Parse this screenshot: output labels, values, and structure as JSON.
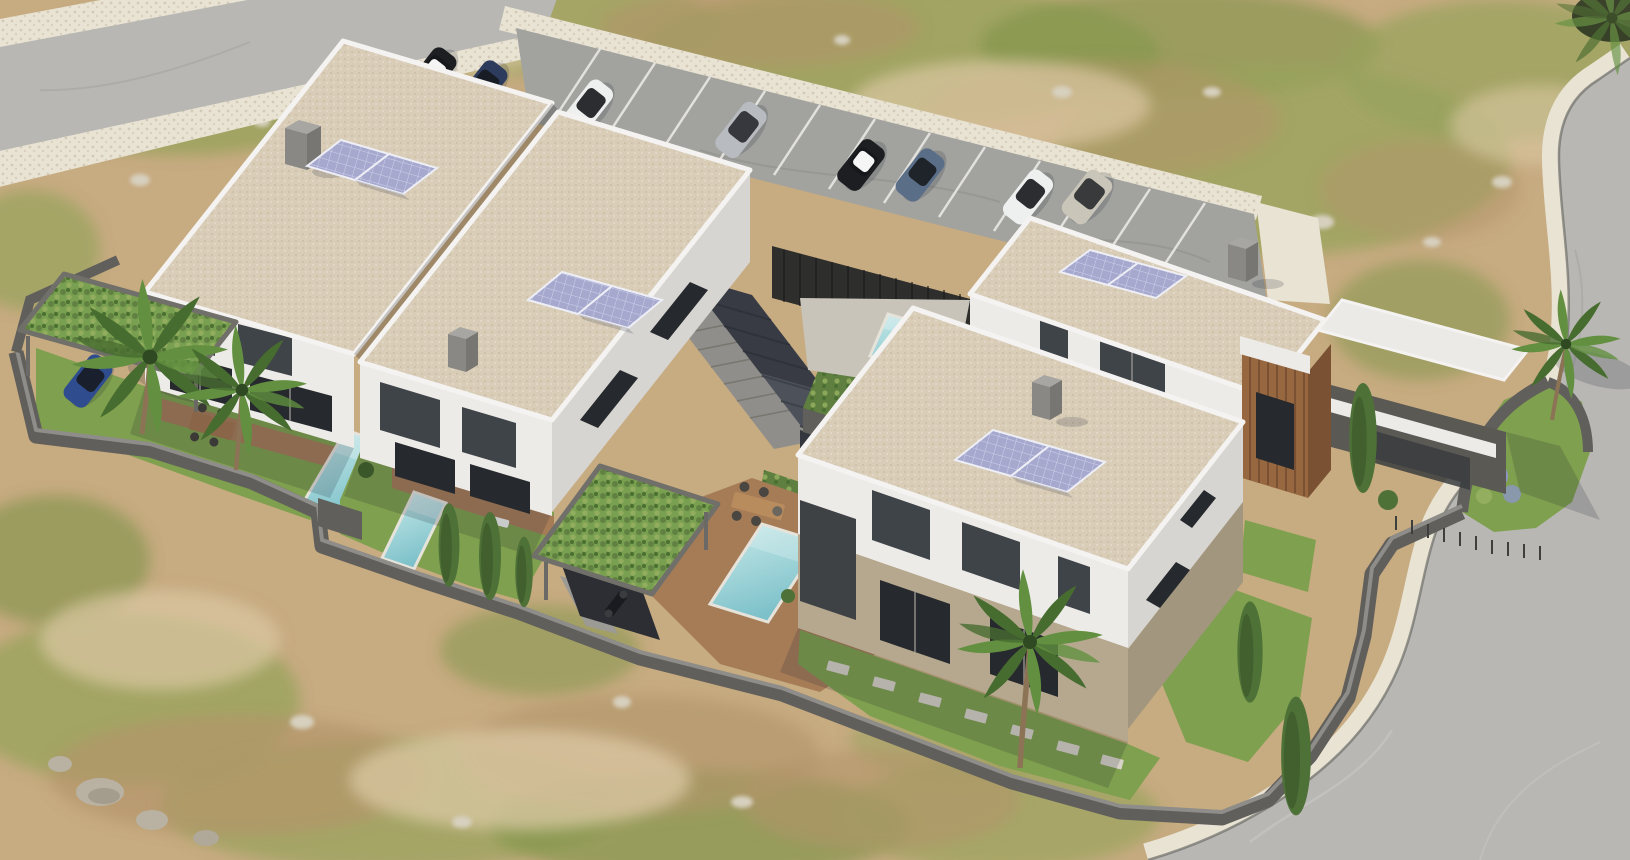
{
  "scene": {
    "title": "Aerial 3D architectural rendering of a modern villa development on a semi-arid plot",
    "type": "architectural-visualization",
    "view": "aerial-oblique",
    "inventory": {
      "building_volumes": 4,
      "duplex_units": 2,
      "detached_villas": 2,
      "rooftop_solar_arrays": 4,
      "solar_panels_per_array": 2,
      "swimming_pools": 4,
      "parked_cars": 8,
      "carport_cars": 1,
      "motorbikes": 1,
      "palm_trees": 5,
      "cypress_trees": 6,
      "green_roof_pergolas": 2,
      "outdoor_dining_sets": 2,
      "sun_loungers": 2,
      "roads": 2,
      "parking_bays": 12
    }
  },
  "colors": {
    "terrain_sand": "#c7ab81",
    "terrain_sand_light": "#dbc8a4",
    "terrain_dirt": "#b3946a",
    "grass_patch": "#97a35b",
    "grass_patch_dark": "#7e9348",
    "stone": "#d7d0bf",
    "road_asphalt": "#b8b7b3",
    "parking_asphalt": "#a2a39f",
    "cobble": "#e9e3d4",
    "cobble_dot": "#d3cbb8",
    "roof_gravel": "#d9cdb8",
    "roof_speckle": "#c1b398",
    "fascia_white": "#f4f3f1",
    "wall_white": "#edebe8",
    "wall_white_shade": "#d7d5d1",
    "wall_beige": "#b5a88f",
    "wall_beige_shade": "#a2967e",
    "window_glass": "#3f4449",
    "window_glass_dark": "#26292d",
    "perimeter_wall_top": "#8e8d89",
    "perimeter_wall_face": "#615f5b",
    "fence_dark": "#2e2e2c",
    "ramp_paving": "#4d5159",
    "stair_concrete": "#8f8e8a",
    "pool_water_light": "#c7e8e8",
    "pool_water": "#9fd4d8",
    "pool_water_deep": "#7cc0c9",
    "pool_rim": "#e6e3db",
    "deck_wood": "#a67c57",
    "deck_wood_dark": "#8a6547",
    "lawn": "#7fa04e",
    "lawn_light": "#93ae5f",
    "pergola_leaves": "#79a050",
    "pergola_frame": "#716f6a",
    "hedge_green": "#5f7f40",
    "palm_frond": "#629040",
    "palm_frond_dark": "#476c2f",
    "palm_trunk": "#8d7355",
    "cypress": "#4e7138",
    "cypress_dark": "#3a5729",
    "wood_slats": "#97683f",
    "wood_slats_dark": "#7a5233",
    "solar_panel": "#a6a8ce",
    "solar_grid": "#ced1e9",
    "solar_frame": "#edeef6",
    "stall_line": "#e9e8e4",
    "shadow_color": "rgba(25,32,48,0.18)",
    "car_black": "#1d1e21",
    "car_white": "#eef0f0",
    "car_roof_white": "#f4f5f4",
    "car_blue_dark": "#2d3b5c",
    "car_silver": "#b8bcc1",
    "car_champagne": "#c9c5b9",
    "car_steel_blue": "#5a6e88",
    "car_blue": "#2e4c8e",
    "car_glass": "#15171b",
    "flower_lavender": "#8d96c4"
  }
}
